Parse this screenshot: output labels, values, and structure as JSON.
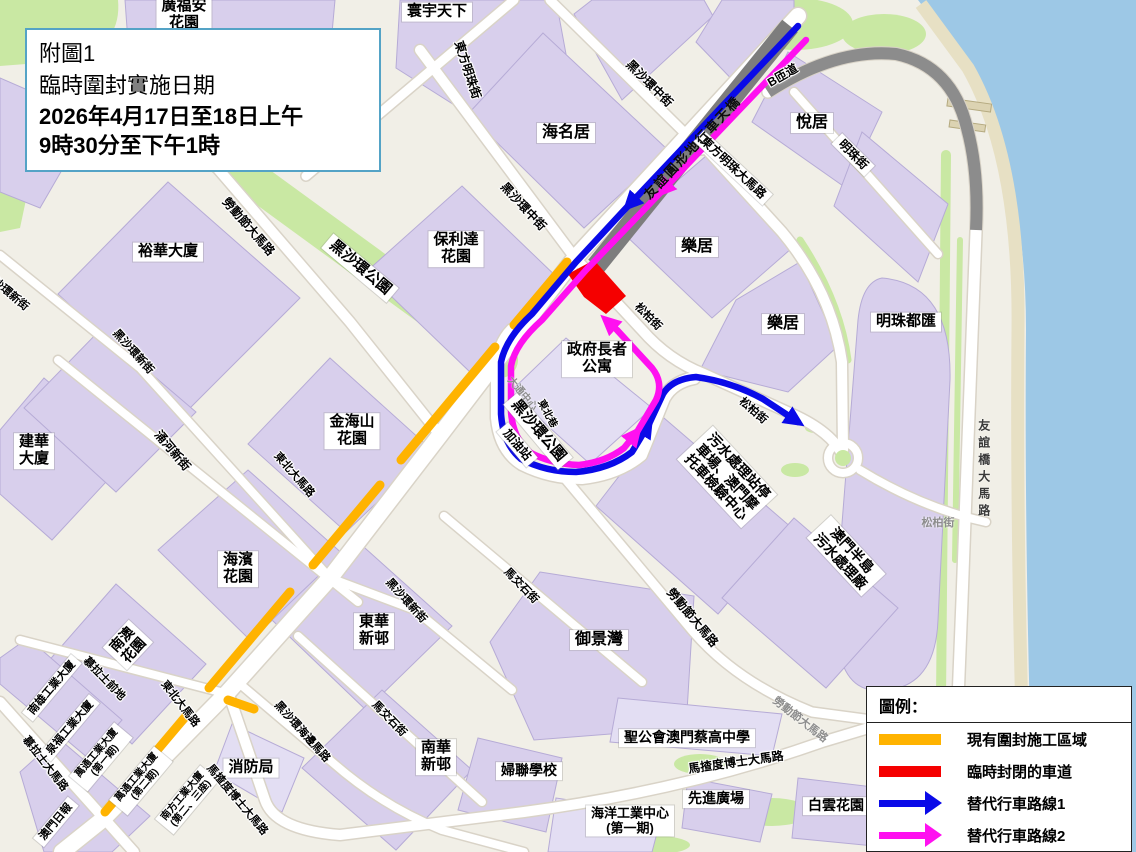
{
  "title_box": {
    "lines": [
      "附圖1",
      "臨時圍封實施日期",
      "2026年4月17日至18日上午",
      "9時30分至下午1時"
    ]
  },
  "legend": {
    "title": "圖例：",
    "items": [
      {
        "swatch": "bar",
        "color": "#FFB300",
        "label": "現有圍封施工區域"
      },
      {
        "swatch": "bar",
        "color": "#F50000",
        "label": "臨時封閉的車道"
      },
      {
        "swatch": "arrow",
        "color": "#0A0AE8",
        "label": "替代行車路線1"
      },
      {
        "swatch": "arrow",
        "color": "#FF10F0",
        "label": "替代行車路線2"
      }
    ]
  },
  "colors": {
    "closure_orange": "#FFB300",
    "closed_lane_red": "#F50000",
    "route1_blue": "#0A0AE8",
    "route2_magenta": "#FF10F0",
    "water": "#9DC8E6",
    "land": "#F1EFE7",
    "building": "#D8CFEC",
    "green": "#C9E8A3",
    "flyover_grey": "#7D7D7D"
  },
  "labels": [
    {
      "t": [
        "寰宇天下"
      ],
      "x": 437,
      "y": 12,
      "r": 0,
      "k": "box",
      "s": 15
    },
    {
      "t": [
        "廣福安",
        "花園"
      ],
      "x": 184,
      "y": 15,
      "r": 0,
      "k": "box",
      "s": 15
    },
    {
      "t": [
        "海名居"
      ],
      "x": 566,
      "y": 133,
      "r": 0,
      "k": "box",
      "s": 16
    },
    {
      "t": [
        "悅居"
      ],
      "x": 812,
      "y": 123,
      "r": 0,
      "k": "box",
      "s": 16
    },
    {
      "t": [
        "保利達",
        "花園"
      ],
      "x": 456,
      "y": 249,
      "r": 0,
      "k": "box",
      "s": 15
    },
    {
      "t": [
        "樂居"
      ],
      "x": 697,
      "y": 247,
      "r": 0,
      "k": "box",
      "s": 16
    },
    {
      "t": [
        "樂居"
      ],
      "x": 783,
      "y": 324,
      "r": 0,
      "k": "box",
      "s": 16
    },
    {
      "t": [
        "明珠都匯"
      ],
      "x": 906,
      "y": 322,
      "r": 0,
      "k": "box",
      "s": 15
    },
    {
      "t": [
        "政府長者",
        "公寓"
      ],
      "x": 597,
      "y": 359,
      "r": 0,
      "k": "box",
      "s": 15
    },
    {
      "t": [
        "裕華大廈"
      ],
      "x": 168,
      "y": 252,
      "r": 0,
      "k": "box",
      "s": 15
    },
    {
      "t": [
        "建華",
        "大廈"
      ],
      "x": 34,
      "y": 451,
      "r": 0,
      "k": "box",
      "s": 15
    },
    {
      "t": [
        "金海山",
        "花園"
      ],
      "x": 352,
      "y": 431,
      "r": 0,
      "k": "box",
      "s": 15
    },
    {
      "t": [
        "海濱",
        "花園"
      ],
      "x": 238,
      "y": 569,
      "r": 0,
      "k": "box",
      "s": 15
    },
    {
      "t": [
        "東華",
        "新邨"
      ],
      "x": 374,
      "y": 631,
      "r": 0,
      "k": "box",
      "s": 15
    },
    {
      "t": [
        "南華",
        "新邨"
      ],
      "x": 436,
      "y": 757,
      "r": 0,
      "k": "box",
      "s": 15
    },
    {
      "t": [
        "御景灣"
      ],
      "x": 599,
      "y": 640,
      "r": 0,
      "k": "box",
      "s": 16
    },
    {
      "t": [
        "婦聯學校"
      ],
      "x": 529,
      "y": 771,
      "r": 0,
      "k": "box",
      "s": 14
    },
    {
      "t": [
        "聖公會澳門蔡高中學"
      ],
      "x": 687,
      "y": 738,
      "r": 0,
      "k": "box",
      "s": 14
    },
    {
      "t": [
        "先進廣場"
      ],
      "x": 716,
      "y": 799,
      "r": 0,
      "k": "box",
      "s": 14
    },
    {
      "t": [
        "白雲花園"
      ],
      "x": 836,
      "y": 806,
      "r": 0,
      "k": "box",
      "s": 14
    },
    {
      "t": [
        "海洋工業中心",
        "(第一期)"
      ],
      "x": 630,
      "y": 821,
      "r": 0,
      "k": "box",
      "s": 13
    },
    {
      "t": [
        "消防局"
      ],
      "x": 251,
      "y": 768,
      "r": 0,
      "k": "box",
      "s": 15
    },
    {
      "t": [
        "黑沙環公園"
      ],
      "x": 360,
      "y": 268,
      "r": 40,
      "k": "box",
      "s": 15
    },
    {
      "t": [
        "黑沙環公園"
      ],
      "x": 538,
      "y": 431,
      "r": 50,
      "k": "box",
      "s": 15
    },
    {
      "t": [
        "加油站"
      ],
      "x": 517,
      "y": 445,
      "r": 50,
      "k": "box",
      "s": 12
    },
    {
      "t": [
        "污水處理站停",
        "車場、澳門摩",
        "托車檢驗中心"
      ],
      "x": 727,
      "y": 477,
      "r": 47,
      "k": "box",
      "s": 14
    },
    {
      "t": [
        "澳門半島",
        "污水處理廠"
      ],
      "x": 846,
      "y": 556,
      "r": 47,
      "k": "box",
      "s": 14
    },
    {
      "t": [
        "南澳",
        "花園"
      ],
      "x": 128,
      "y": 645,
      "r": -47,
      "k": "box",
      "s": 14
    },
    {
      "t": [
        "南雄工業大廈"
      ],
      "x": 52,
      "y": 688,
      "r": -50,
      "k": "box",
      "s": 11
    },
    {
      "t": [
        "泉福工業大廈"
      ],
      "x": 70,
      "y": 728,
      "r": -50,
      "k": "box",
      "s": 11
    },
    {
      "t": [
        "萬通工業大廈",
        "(第一期)"
      ],
      "x": 101,
      "y": 757,
      "r": -50,
      "k": "box",
      "s": 10
    },
    {
      "t": [
        "萬通工業大廈",
        "(第二期)"
      ],
      "x": 141,
      "y": 781,
      "r": -50,
      "k": "box",
      "s": 10
    },
    {
      "t": [
        "南方工業大廈",
        "(第二、三座)"
      ],
      "x": 187,
      "y": 800,
      "r": -50,
      "k": "box",
      "s": 10
    },
    {
      "t": [
        "澳門日報"
      ],
      "x": 56,
      "y": 822,
      "r": -50,
      "k": "box",
      "s": 11
    },
    {
      "t": [
        "東方明珠大馬路"
      ],
      "x": 733,
      "y": 168,
      "r": 43,
      "k": "box",
      "s": 12
    },
    {
      "t": [
        "明珠街"
      ],
      "x": 853,
      "y": 155,
      "r": 45,
      "k": "box",
      "s": 12
    },
    {
      "t": [
        "黑沙環中街"
      ],
      "x": 649,
      "y": 84,
      "r": 45,
      "k": "street",
      "s": 12
    },
    {
      "t": [
        "黑沙環中街"
      ],
      "x": 523,
      "y": 207,
      "r": 47,
      "k": "street",
      "s": 12
    },
    {
      "t": [
        "東方明珠街"
      ],
      "x": 467,
      "y": 70,
      "r": 72,
      "k": "street",
      "s": 12
    },
    {
      "t": [
        "友誼圓形地行車天橋"
      ],
      "x": 693,
      "y": 148,
      "r": -47,
      "k": "grey",
      "s": 13
    },
    {
      "t": [
        "B匝道"
      ],
      "x": 783,
      "y": 76,
      "r": -30,
      "k": "street",
      "s": 12
    },
    {
      "t": [
        "勞動節大馬路"
      ],
      "x": 248,
      "y": 227,
      "r": 49,
      "k": "street",
      "s": 12
    },
    {
      "t": [
        "勞動節大馬路"
      ],
      "x": 692,
      "y": 618,
      "r": 50,
      "k": "street",
      "s": 12
    },
    {
      "t": [
        "勞動節大馬路"
      ],
      "x": 800,
      "y": 720,
      "r": 38,
      "k": "faint",
      "s": 11
    },
    {
      "t": [
        "黑沙環新街"
      ],
      "x": 6,
      "y": 291,
      "r": 40,
      "k": "street",
      "s": 11
    },
    {
      "t": [
        "黑沙環新街"
      ],
      "x": 133,
      "y": 352,
      "r": 48,
      "k": "street",
      "s": 11
    },
    {
      "t": [
        "黑沙環新街"
      ],
      "x": 406,
      "y": 601,
      "r": 48,
      "k": "street",
      "s": 11
    },
    {
      "t": [
        "涌河新街"
      ],
      "x": 172,
      "y": 451,
      "r": 50,
      "k": "street",
      "s": 12
    },
    {
      "t": [
        "馬交石街"
      ],
      "x": 521,
      "y": 586,
      "r": 46,
      "k": "street",
      "s": 11
    },
    {
      "t": [
        "馬交石街"
      ],
      "x": 389,
      "y": 719,
      "r": 46,
      "k": "street",
      "s": 11
    },
    {
      "t": [
        "慕拉士前地"
      ],
      "x": 104,
      "y": 679,
      "r": 46,
      "k": "street",
      "s": 11
    },
    {
      "t": [
        "慕拉士大馬路"
      ],
      "x": 45,
      "y": 764,
      "r": 52,
      "k": "street",
      "s": 11
    },
    {
      "t": [
        "東北大馬路"
      ],
      "x": 294,
      "y": 475,
      "r": 49,
      "k": "street",
      "s": 11
    },
    {
      "t": [
        "東北大馬路"
      ],
      "x": 180,
      "y": 704,
      "r": 52,
      "k": "street",
      "s": 11
    },
    {
      "t": [
        "黑沙環海邊馬路"
      ],
      "x": 302,
      "y": 732,
      "r": 48,
      "k": "street",
      "s": 11
    },
    {
      "t": [
        "馬揸度博士大馬路"
      ],
      "x": 237,
      "y": 800,
      "r": 50,
      "k": "street",
      "s": 11
    },
    {
      "t": [
        "馬揸度博士大馬路"
      ],
      "x": 736,
      "y": 763,
      "r": -8,
      "k": "street",
      "s": 12
    },
    {
      "t": [
        "松柏街"
      ],
      "x": 648,
      "y": 317,
      "r": 45,
      "k": "street",
      "s": 11
    },
    {
      "t": [
        "松柏街"
      ],
      "x": 753,
      "y": 411,
      "r": 41,
      "k": "street",
      "s": 11
    },
    {
      "t": [
        "松柏街"
      ],
      "x": 938,
      "y": 523,
      "r": 0,
      "k": "faint",
      "s": 11
    },
    {
      "t": [
        "東北巷"
      ],
      "x": 547,
      "y": 414,
      "r": 62,
      "k": "street",
      "s": 10
    },
    {
      "t": [
        "大通中心"
      ],
      "x": 522,
      "y": 394,
      "r": 50,
      "k": "faint",
      "s": 10
    },
    {
      "t": [
        "友誼橋大馬路"
      ],
      "x": 983,
      "y": 470,
      "r": 0,
      "k": "vert",
      "s": 12
    }
  ]
}
